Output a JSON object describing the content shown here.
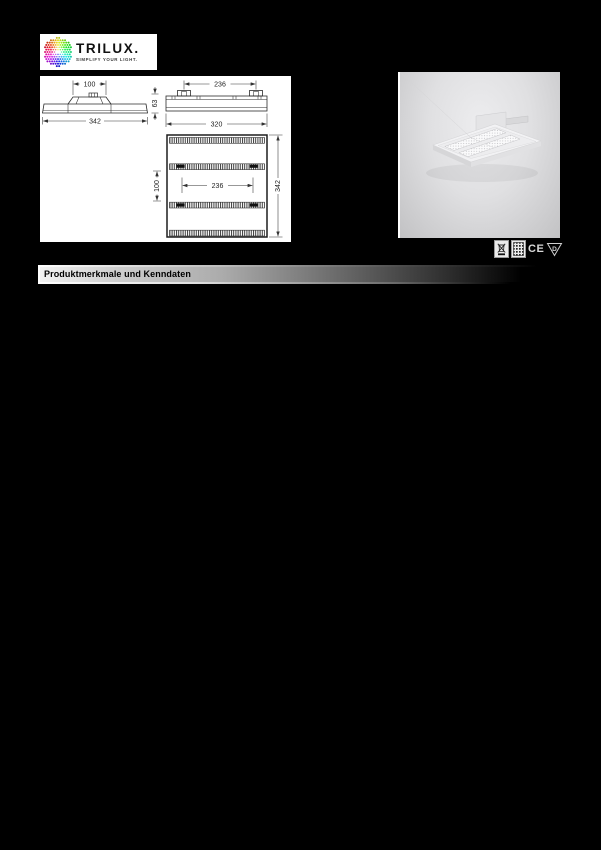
{
  "page": {
    "background_color": "#000000"
  },
  "logo": {
    "brand": "TRILUX.",
    "tagline": "SIMPLIFY YOUR LIGHT."
  },
  "technical_drawings": {
    "front_view": {
      "gear_tray_width": "100",
      "overall_width": "342",
      "height": "63"
    },
    "end_view": {
      "suspension_distance": "236",
      "overall_width": "320"
    },
    "plan_view": {
      "inner_width": "236",
      "row_spacing": "100",
      "overall_length": "342"
    }
  },
  "certification_icons": [
    {
      "name": "weee-crossed-bin-icon",
      "label": ""
    },
    {
      "name": "grid-pattern-icon",
      "label": ""
    },
    {
      "name": "ce-mark",
      "label": "CE"
    },
    {
      "name": "triangle-d-mark",
      "label": "D"
    }
  ],
  "section_header": {
    "title": "Produktmerkmale und Kenndaten"
  },
  "colors": {
    "page_background": "#000000",
    "content_background": "#ffffff",
    "bar_gradient_start": "#f2f2f2",
    "bar_gradient_end": "#000000",
    "photo_background": "#d9d9db"
  }
}
